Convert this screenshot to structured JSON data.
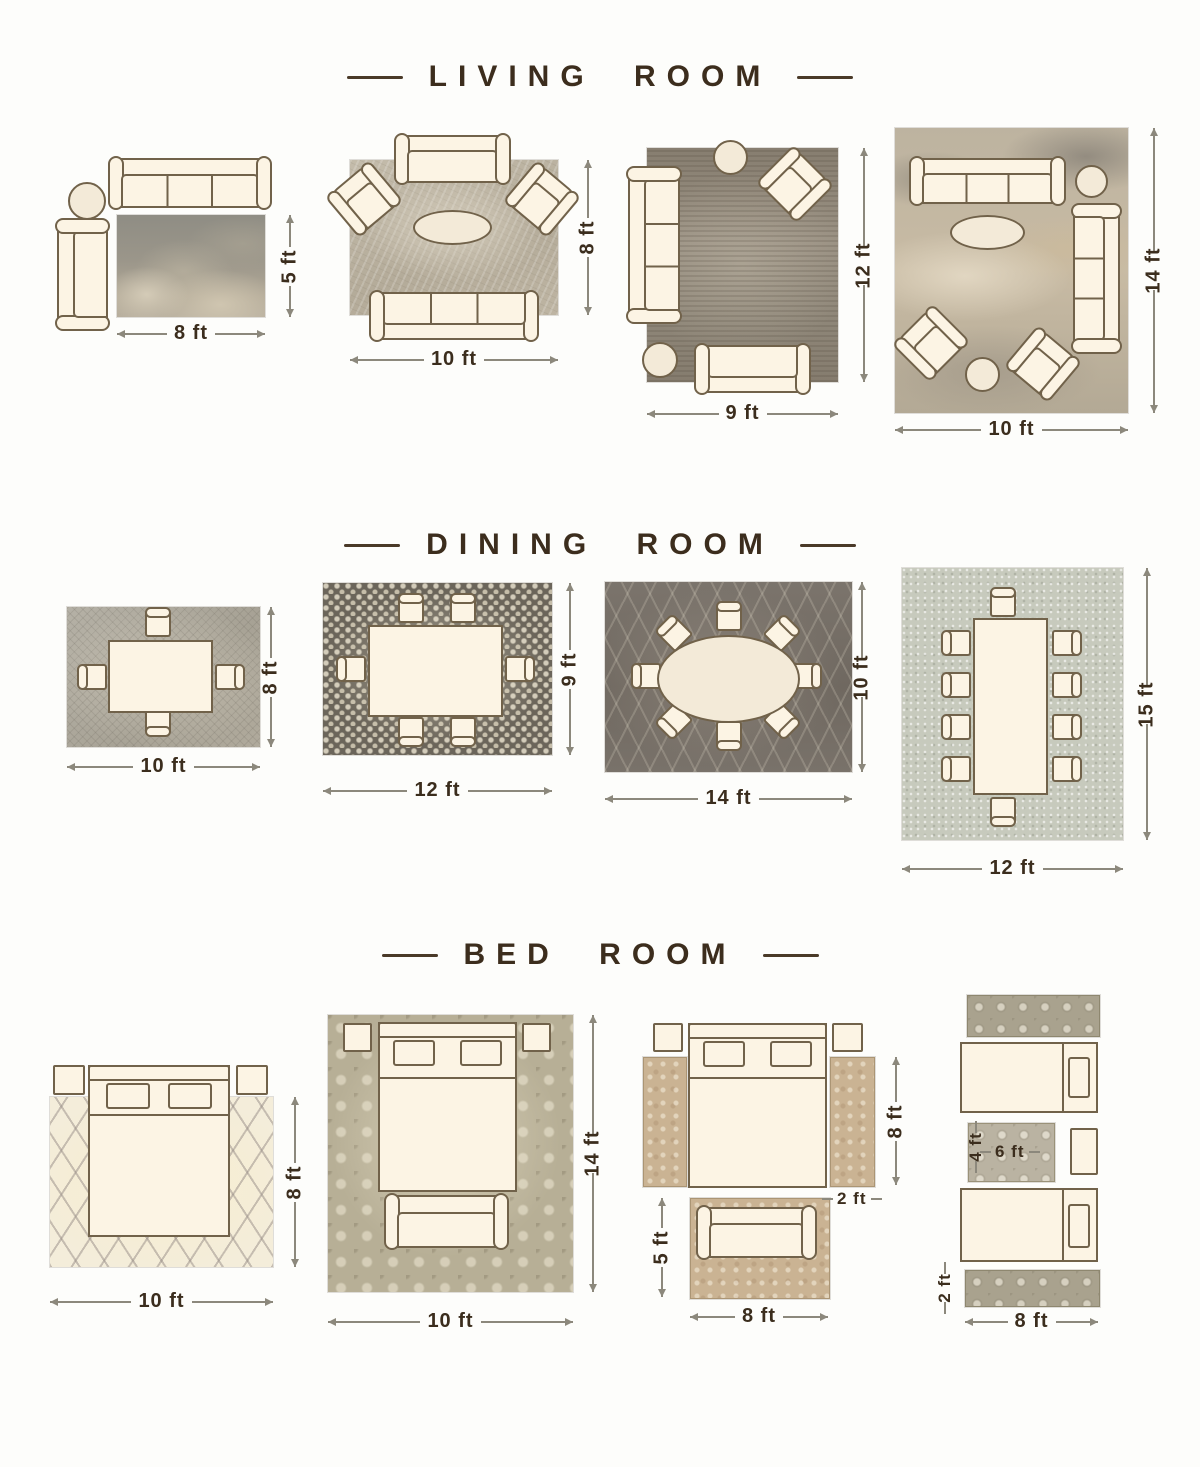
{
  "page": {
    "background": "#fdfdfb"
  },
  "colors": {
    "accent_text": "#3b2d1d",
    "dimension_line": "#8c887c",
    "furniture_outline": "#71624a",
    "furniture_fill": "#fcf4e4"
  },
  "sections": [
    {
      "title": "LIVING ROOM",
      "layouts": [
        {
          "width": "8 ft",
          "height": "5 ft"
        },
        {
          "width": "10 ft",
          "height": "8 ft"
        },
        {
          "width": "9 ft",
          "height": "12 ft"
        },
        {
          "width": "10 ft",
          "height": "14 ft"
        }
      ]
    },
    {
      "title": "DINING ROOM",
      "layouts": [
        {
          "width": "10 ft",
          "height": "8 ft"
        },
        {
          "width": "12 ft",
          "height": "9 ft"
        },
        {
          "width": "14 ft",
          "height": "10 ft"
        },
        {
          "width": "12 ft",
          "height": "15 ft"
        }
      ]
    },
    {
      "title": "BED ROOM",
      "layouts": [
        {
          "width": "10 ft",
          "height": "8 ft"
        },
        {
          "width": "10 ft",
          "height": "14 ft"
        },
        {
          "runner_height": "8 ft",
          "runner_width": "2 ft",
          "accent_width": "8 ft",
          "accent_height": "5 ft"
        },
        {
          "center_height": "4 ft",
          "center_width": "6 ft",
          "runner_width": "2 ft",
          "bottom_width": "8 ft"
        }
      ]
    }
  ]
}
